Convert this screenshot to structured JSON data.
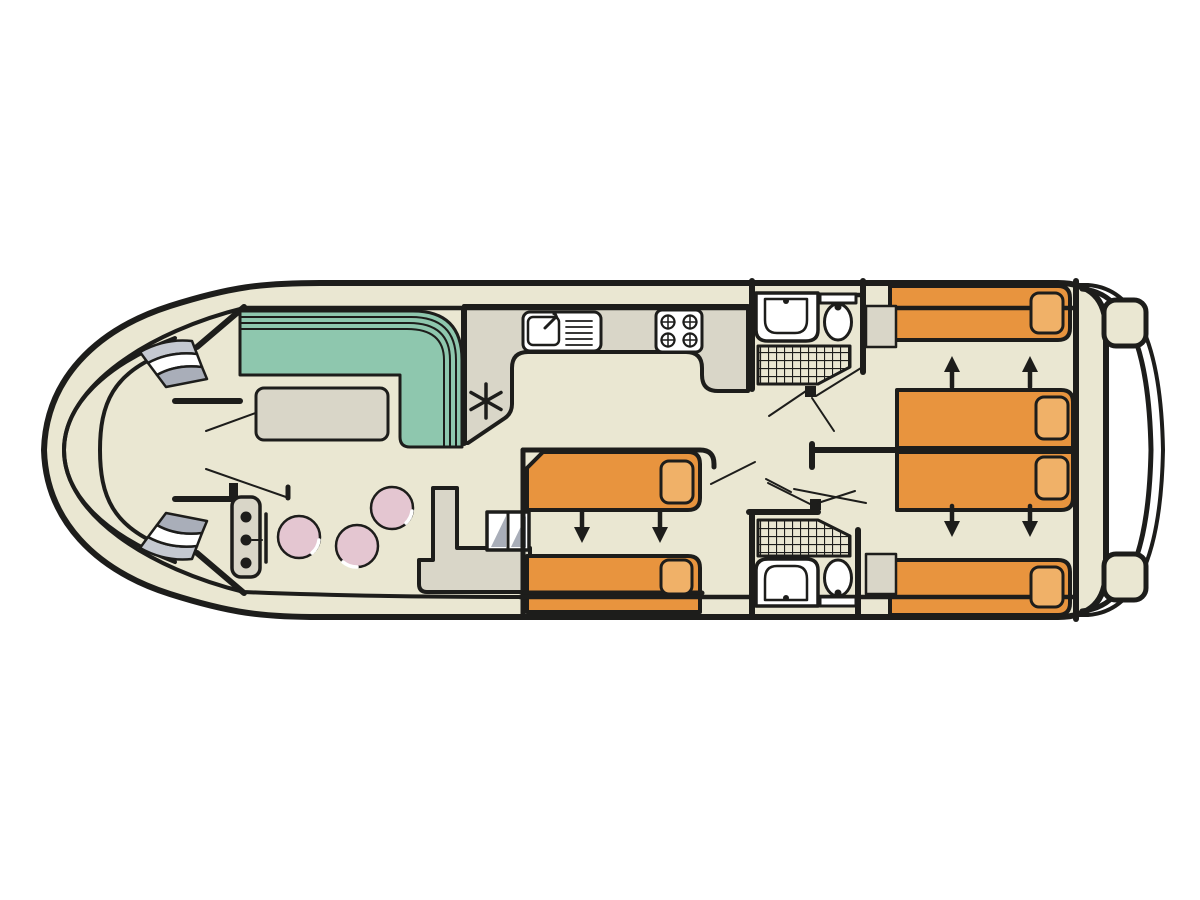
{
  "meta": {
    "type": "boat-floor-plan",
    "orientation": "bow-left",
    "view": "top-down deck plan"
  },
  "colors": {
    "background": "#ffffff",
    "outline": "#1d1d1b",
    "deck": "#eae7d2",
    "counter": "#d9d6c8",
    "sofa": "#8ec7ae",
    "bed": "#e8943e",
    "pillow": "#f0b168",
    "stool": "#e4c6d1",
    "step_gray": "#c5c9d1",
    "step_dark": "#a9aeb9",
    "white": "#ffffff"
  },
  "symbols": {
    "galley_marker": "six-spoke-asterisk",
    "slide_arrow": "solid-black-arrow",
    "shower": "hatched-grid-square-tray",
    "door": "thin-swing-line-with-hinge-block"
  },
  "areas": [
    {
      "name": "bow-deck",
      "features": [
        "curved-bench",
        "entry-steps-top",
        "entry-steps-bottom"
      ]
    },
    {
      "name": "saloon",
      "features": [
        "l-shaped-sofa",
        "table",
        "helm-console-with-throttle",
        "stool",
        "stool",
        "stool"
      ]
    },
    {
      "name": "galley",
      "features": [
        "worktop",
        "sink-with-drainer",
        "four-burner-hob",
        "asterisk-marker",
        "companionway-steps",
        "side-platform"
      ]
    },
    {
      "name": "mid-cabin",
      "features": [
        "single-bed",
        "single-bed",
        "pillow",
        "pillow",
        "slide-together-arrows-down"
      ]
    },
    {
      "name": "shower-room-forward",
      "features": [
        "washbasin",
        "toilet",
        "shower-tray"
      ]
    },
    {
      "name": "shower-room-aft",
      "features": [
        "washbasin",
        "toilet",
        "shower-tray"
      ]
    },
    {
      "name": "aft-cabin-upper",
      "features": [
        "single-bed",
        "single-bed",
        "pillow",
        "pillow",
        "wardrobe",
        "slide-together-arrows-up"
      ]
    },
    {
      "name": "aft-cabin-lower",
      "features": [
        "single-bed",
        "single-bed",
        "pillow",
        "pillow",
        "wardrobe",
        "slide-together-arrows-down"
      ]
    },
    {
      "name": "stern-deck",
      "features": [
        "curved-bench",
        "cleat",
        "cleat",
        "swim-platform"
      ]
    }
  ],
  "counts": {
    "single_beds": 6,
    "pillows": 6,
    "stools": 3,
    "toilets": 2,
    "washbasins": 2,
    "showers": 2,
    "slide_arrows": 6,
    "cleats": 2
  }
}
